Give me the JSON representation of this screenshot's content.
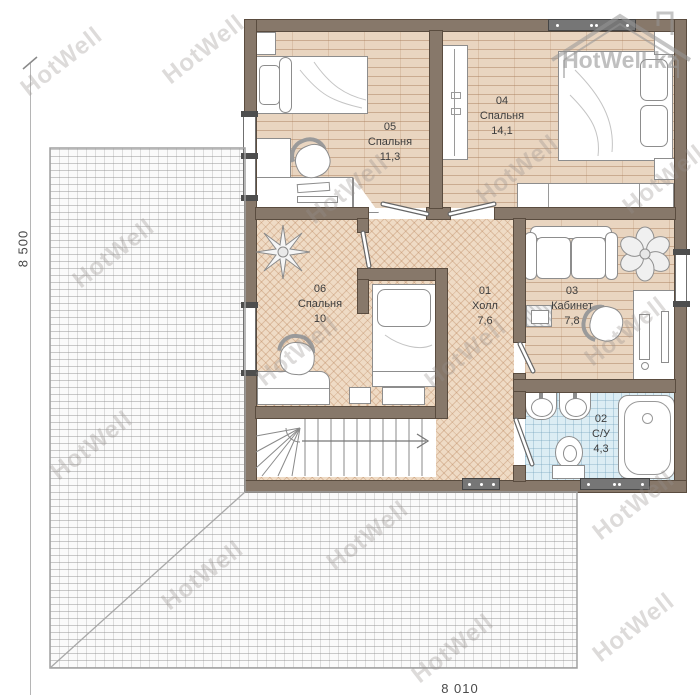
{
  "dimensions": {
    "left": "8 500",
    "bottom": "8 010"
  },
  "watermark": {
    "text": "HotWell",
    "logo_text": "HotWell.kz"
  },
  "rooms": [
    {
      "number": "05",
      "name": "Спальня",
      "area": "11,3"
    },
    {
      "number": "04",
      "name": "Спальня",
      "area": "14,1"
    },
    {
      "number": "06",
      "name": "Спальня",
      "area": "10"
    },
    {
      "number": "01",
      "name": "Холл",
      "area": "7,6"
    },
    {
      "number": "03",
      "name": "Кабинет",
      "area": "7,8"
    },
    {
      "number": "02",
      "name": "С/У",
      "area": "4,3"
    }
  ],
  "colors": {
    "wall": "#87786a",
    "plank_floor": "#e9d5c0",
    "herringbone_floor": "#efdbc5",
    "tile_floor": "#dcedf4",
    "roof": "#fafafa",
    "watermark": "#9a9591"
  }
}
